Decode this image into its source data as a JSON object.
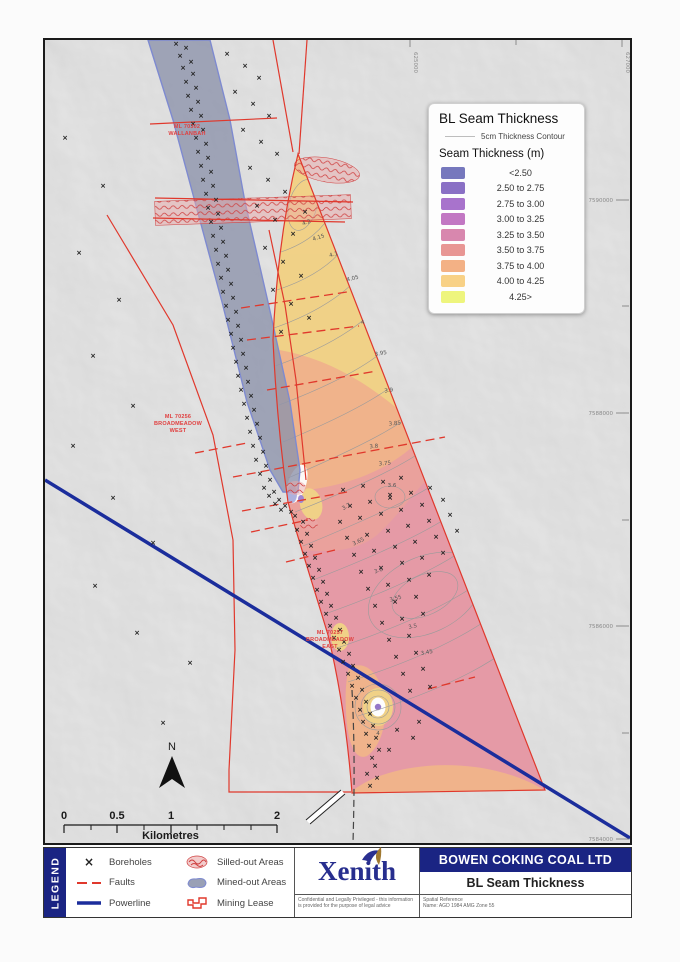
{
  "map": {
    "north_label": "N",
    "labels": {
      "wallanbah": {
        "lines": [
          "ML 70302",
          "WALLANBAH"
        ],
        "x": 94,
        "y": 84
      },
      "west": {
        "lines": [
          "ML 70256",
          "BROADMEADOW",
          "WEST"
        ],
        "x": 85,
        "y": 374
      },
      "east": {
        "lines": [
          "ML 70257",
          "BROADMEADOW",
          "EAST"
        ],
        "x": 237,
        "y": 590
      }
    },
    "grid": {
      "northings": [
        {
          "label": "7590000",
          "y": 160
        },
        {
          "label": "7588000",
          "y": 373
        },
        {
          "label": "7586000",
          "y": 586
        },
        {
          "label": "7584000",
          "y": 799
        }
      ],
      "northing_minor": [
        266,
        480,
        693
      ],
      "eastings": [
        {
          "label": "625000",
          "x": 365
        },
        {
          "label": "627000",
          "x": 577
        }
      ],
      "easting_minor": [
        471
      ]
    },
    "scalebar": {
      "unit": "Kilometres",
      "ticks_major": [
        {
          "label": "0",
          "x": 19
        },
        {
          "label": "0.5",
          "x": 72
        },
        {
          "label": "1",
          "x": 126
        },
        {
          "label": "2",
          "x": 232
        }
      ],
      "ticks_minor": [
        46,
        99,
        152,
        179,
        206
      ]
    },
    "contour_labels": [
      {
        "v": "4.2",
        "x": 262,
        "y": 184,
        "r": -20
      },
      {
        "v": "4.15",
        "x": 274,
        "y": 199,
        "r": -18
      },
      {
        "v": "4.1",
        "x": 289,
        "y": 216,
        "r": -16
      },
      {
        "v": "4.05",
        "x": 308,
        "y": 240,
        "r": -14
      },
      {
        "v": "4",
        "x": 318,
        "y": 284,
        "r": -10
      },
      {
        "v": "3.95",
        "x": 336,
        "y": 315,
        "r": -10
      },
      {
        "v": "3.9",
        "x": 344,
        "y": 352,
        "r": -8
      },
      {
        "v": "3.85",
        "x": 350,
        "y": 385,
        "r": -6
      },
      {
        "v": "3.8",
        "x": 329,
        "y": 408,
        "r": -5
      },
      {
        "v": "3.75",
        "x": 340,
        "y": 425,
        "r": -5
      },
      {
        "v": "3.7",
        "x": 302,
        "y": 468,
        "r": -30
      },
      {
        "v": "3.65",
        "x": 314,
        "y": 503,
        "r": -25
      },
      {
        "v": "3.6",
        "x": 334,
        "y": 532,
        "r": -20
      },
      {
        "v": "3.55",
        "x": 351,
        "y": 560,
        "r": -15
      },
      {
        "v": "3.5",
        "x": 368,
        "y": 588,
        "r": -12
      },
      {
        "v": "3.45",
        "x": 382,
        "y": 614,
        "r": -10
      },
      {
        "v": "3.6",
        "x": 347,
        "y": 447,
        "r": 0
      },
      {
        "v": "4",
        "x": 333,
        "y": 695,
        "r": 0
      }
    ],
    "faults": [
      [
        196,
        268,
        302,
        252
      ],
      [
        202,
        300,
        314,
        286
      ],
      [
        222,
        350,
        332,
        331
      ],
      [
        150,
        413,
        202,
        403
      ],
      [
        188,
        437,
        400,
        397
      ],
      [
        197,
        471,
        302,
        452
      ],
      [
        206,
        492,
        263,
        480
      ],
      [
        241,
        522,
        290,
        510
      ],
      [
        383,
        649,
        430,
        637
      ]
    ],
    "boreholes": [
      [
        131,
        6
      ],
      [
        141,
        10
      ],
      [
        135,
        18
      ],
      [
        146,
        24
      ],
      [
        138,
        30
      ],
      [
        148,
        36
      ],
      [
        141,
        44
      ],
      [
        151,
        50
      ],
      [
        143,
        58
      ],
      [
        153,
        64
      ],
      [
        146,
        72
      ],
      [
        156,
        78
      ],
      [
        148,
        86
      ],
      [
        158,
        92
      ],
      [
        151,
        100
      ],
      [
        161,
        106
      ],
      [
        153,
        114
      ],
      [
        163,
        120
      ],
      [
        156,
        128
      ],
      [
        166,
        134
      ],
      [
        158,
        142
      ],
      [
        168,
        148
      ],
      [
        161,
        156
      ],
      [
        171,
        162
      ],
      [
        163,
        170
      ],
      [
        173,
        176
      ],
      [
        166,
        184
      ],
      [
        176,
        190
      ],
      [
        168,
        198
      ],
      [
        178,
        204
      ],
      [
        171,
        212
      ],
      [
        181,
        218
      ],
      [
        173,
        226
      ],
      [
        183,
        232
      ],
      [
        176,
        240
      ],
      [
        186,
        246
      ],
      [
        178,
        254
      ],
      [
        188,
        260
      ],
      [
        181,
        268
      ],
      [
        191,
        274
      ],
      [
        183,
        282
      ],
      [
        193,
        288
      ],
      [
        186,
        296
      ],
      [
        196,
        302
      ],
      [
        188,
        310
      ],
      [
        198,
        316
      ],
      [
        191,
        324
      ],
      [
        201,
        330
      ],
      [
        193,
        338
      ],
      [
        203,
        344
      ],
      [
        196,
        352
      ],
      [
        206,
        358
      ],
      [
        199,
        366
      ],
      [
        209,
        372
      ],
      [
        202,
        380
      ],
      [
        212,
        386
      ],
      [
        205,
        394
      ],
      [
        215,
        400
      ],
      [
        208,
        408
      ],
      [
        218,
        414
      ],
      [
        211,
        422
      ],
      [
        221,
        428
      ],
      [
        215,
        436
      ],
      [
        225,
        442
      ],
      [
        219,
        450
      ],
      [
        229,
        454
      ],
      [
        224,
        458
      ],
      [
        234,
        462
      ],
      [
        230,
        466
      ],
      [
        240,
        468
      ],
      [
        236,
        472
      ],
      [
        246,
        474
      ],
      [
        250,
        478
      ],
      [
        258,
        484
      ],
      [
        252,
        492
      ],
      [
        262,
        496
      ],
      [
        256,
        504
      ],
      [
        266,
        508
      ],
      [
        260,
        516
      ],
      [
        270,
        520
      ],
      [
        264,
        528
      ],
      [
        274,
        532
      ],
      [
        268,
        540
      ],
      [
        278,
        544
      ],
      [
        272,
        552
      ],
      [
        282,
        556
      ],
      [
        276,
        564
      ],
      [
        286,
        568
      ],
      [
        281,
        576
      ],
      [
        291,
        580
      ],
      [
        285,
        588
      ],
      [
        295,
        592
      ],
      [
        289,
        600
      ],
      [
        299,
        604
      ],
      [
        294,
        612
      ],
      [
        304,
        616
      ],
      [
        298,
        624
      ],
      [
        308,
        628
      ],
      [
        303,
        636
      ],
      [
        313,
        640
      ],
      [
        307,
        648
      ],
      [
        317,
        652
      ],
      [
        311,
        660
      ],
      [
        321,
        664
      ],
      [
        315,
        672
      ],
      [
        325,
        676
      ],
      [
        318,
        684
      ],
      [
        328,
        688
      ],
      [
        321,
        696
      ],
      [
        331,
        700
      ],
      [
        324,
        708
      ],
      [
        334,
        712
      ],
      [
        327,
        720
      ],
      [
        330,
        728
      ],
      [
        322,
        736
      ],
      [
        332,
        740
      ],
      [
        325,
        748
      ],
      [
        182,
        16
      ],
      [
        200,
        28
      ],
      [
        214,
        40
      ],
      [
        190,
        54
      ],
      [
        208,
        66
      ],
      [
        224,
        78
      ],
      [
        198,
        92
      ],
      [
        216,
        104
      ],
      [
        232,
        116
      ],
      [
        205,
        130
      ],
      [
        223,
        142
      ],
      [
        240,
        154
      ],
      [
        212,
        168
      ],
      [
        230,
        182
      ],
      [
        248,
        196
      ],
      [
        220,
        210
      ],
      [
        238,
        224
      ],
      [
        256,
        238
      ],
      [
        228,
        252
      ],
      [
        246,
        266
      ],
      [
        264,
        280
      ],
      [
        236,
        294
      ],
      [
        260,
        174
      ],
      [
        20,
        100
      ],
      [
        58,
        148
      ],
      [
        34,
        215
      ],
      [
        74,
        262
      ],
      [
        48,
        318
      ],
      [
        88,
        368
      ],
      [
        28,
        408
      ],
      [
        68,
        460
      ],
      [
        108,
        505
      ],
      [
        50,
        548
      ],
      [
        92,
        595
      ],
      [
        145,
        625
      ],
      [
        118,
        685
      ],
      [
        298,
        452
      ],
      [
        318,
        448
      ],
      [
        338,
        444
      ],
      [
        356,
        440
      ],
      [
        305,
        468
      ],
      [
        325,
        464
      ],
      [
        345,
        460
      ],
      [
        366,
        455
      ],
      [
        385,
        450
      ],
      [
        295,
        484
      ],
      [
        315,
        480
      ],
      [
        336,
        476
      ],
      [
        356,
        472
      ],
      [
        377,
        467
      ],
      [
        398,
        462
      ],
      [
        302,
        500
      ],
      [
        322,
        497
      ],
      [
        343,
        493
      ],
      [
        363,
        488
      ],
      [
        384,
        483
      ],
      [
        405,
        477
      ],
      [
        309,
        517
      ],
      [
        329,
        513
      ],
      [
        350,
        509
      ],
      [
        370,
        504
      ],
      [
        391,
        499
      ],
      [
        412,
        493
      ],
      [
        316,
        534
      ],
      [
        336,
        530
      ],
      [
        357,
        525
      ],
      [
        377,
        520
      ],
      [
        398,
        515
      ],
      [
        323,
        551
      ],
      [
        343,
        547
      ],
      [
        364,
        542
      ],
      [
        384,
        537
      ],
      [
        330,
        568
      ],
      [
        350,
        564
      ],
      [
        371,
        559
      ],
      [
        337,
        585
      ],
      [
        357,
        581
      ],
      [
        378,
        576
      ],
      [
        344,
        602
      ],
      [
        364,
        598
      ],
      [
        351,
        619
      ],
      [
        371,
        615
      ],
      [
        358,
        636
      ],
      [
        378,
        631
      ],
      [
        365,
        653
      ],
      [
        385,
        649
      ],
      [
        352,
        692
      ],
      [
        368,
        700
      ],
      [
        344,
        712
      ],
      [
        374,
        684
      ],
      [
        345,
        457
      ]
    ]
  },
  "legend_box": {
    "title": "BL Seam Thickness",
    "contour_label": "5cm Thickness Contour",
    "subtitle": "Seam Thickness (m)",
    "classes": [
      {
        "label": "<2.50",
        "color": "#7678bd"
      },
      {
        "label": "2.50 to 2.75",
        "color": "#8a70c5"
      },
      {
        "label": "2.75 to 3.00",
        "color": "#a873cc"
      },
      {
        "label": "3.00 to 3.25",
        "color": "#c277c3"
      },
      {
        "label": "3.25 to 3.50",
        "color": "#d887ae"
      },
      {
        "label": "3.50 to 3.75",
        "color": "#e89694"
      },
      {
        "label": "3.75 to 4.00",
        "color": "#f3b185"
      },
      {
        "label": "4.00 to 4.25",
        "color": "#f8d186"
      },
      {
        "label": "4.25>",
        "color": "#eef57d"
      }
    ]
  },
  "legend_strip": {
    "banner": "LEGEND",
    "col1": [
      {
        "icon": "boreholes-icon",
        "label": "Boreholes"
      },
      {
        "icon": "faults-icon",
        "label": "Faults"
      },
      {
        "icon": "powerline-icon",
        "label": "Powerline"
      }
    ],
    "col2": [
      {
        "icon": "silled-icon",
        "label": "Silled-out Areas"
      },
      {
        "icon": "mined-icon",
        "label": "Mined-out Areas"
      },
      {
        "icon": "lease-icon",
        "label": "Mining Lease"
      }
    ]
  },
  "title_block": {
    "logo_text": "Xenith",
    "company": "BOWEN COKING COAL LTD",
    "map_title": "BL Seam Thickness",
    "confidential": "Confidential and Legally Privileged - this information is provided for the purpose of legal advice",
    "spatial_ref_heading": "Spatial Reference",
    "spatial_ref_name": "Name: AGD 1984 AMG Zone 55"
  },
  "colors": {
    "yellow": "#f2d080",
    "orange": "#f1b085",
    "salmon": "#eb9d97",
    "pink": "#e695a2",
    "purple": "#8f6fc7",
    "corridor": "#8d94ab",
    "corridor_edge": "#7e8ad0",
    "red_line": "#e0382c",
    "powerline": "#1b2d9c",
    "banner_blue": "#1a2483"
  }
}
